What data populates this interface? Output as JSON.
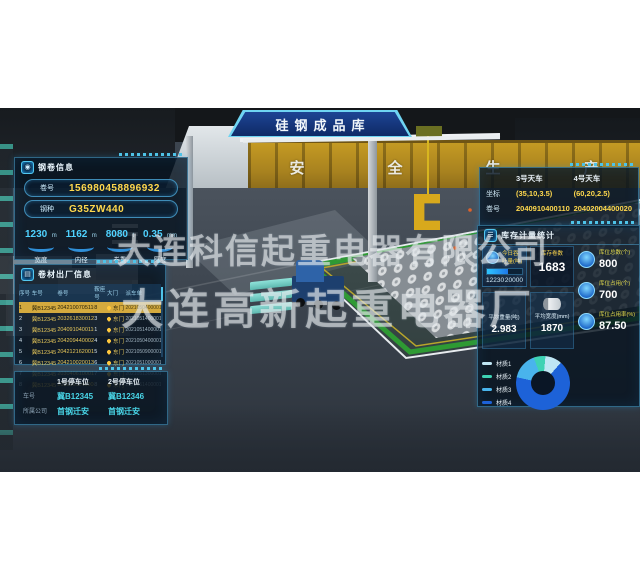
{
  "banner": {
    "title": "硅钢成品库"
  },
  "watermark": {
    "line1": "大连科信起重电器有限公司",
    "line2": "大连高新起重电器厂"
  },
  "scene": {
    "girder_text": [
      "安",
      "全",
      "生",
      "产"
    ]
  },
  "coil_info": {
    "title": "钢卷信息",
    "fields": [
      {
        "label": "卷号",
        "value": "156980458896932"
      },
      {
        "label": "钢种",
        "value": "G35ZW440"
      }
    ],
    "stats": [
      {
        "value": "1230",
        "unit": "m",
        "label": "宽度"
      },
      {
        "value": "1162",
        "unit": "m",
        "label": "内径"
      },
      {
        "value": "8080",
        "unit": "t",
        "label": "卷重"
      },
      {
        "value": "0.35",
        "unit": "mm",
        "label": "厚度"
      }
    ]
  },
  "shipment": {
    "title": "卷材出厂信息",
    "columns": [
      "序号",
      "车号",
      "卷号",
      "鞍座号",
      "大门",
      "派车单"
    ],
    "rows": [
      {
        "no": "1",
        "truck": "冀B12345",
        "coil": "2042100705110",
        "seat": "8",
        "gate": "东门",
        "dispatch": "2021050400001"
      },
      {
        "no": "2",
        "truck": "冀B12345",
        "coil": "2032618300120",
        "seat": "3",
        "gate": "东门",
        "dispatch": "2021051400001"
      },
      {
        "no": "3",
        "truck": "冀B12345",
        "coil": "2040910400110",
        "seat": "1",
        "gate": "东门",
        "dispatch": "2021051400001"
      },
      {
        "no": "4",
        "truck": "冀B12345",
        "coil": "2042094400020",
        "seat": "4",
        "gate": "东门",
        "dispatch": "2021050400001"
      },
      {
        "no": "5",
        "truck": "冀B12345",
        "coil": "2042121620010",
        "seat": "5",
        "gate": "东门",
        "dispatch": "2021050900001"
      },
      {
        "no": "6",
        "truck": "冀B12345",
        "coil": "2042100200130",
        "seat": "6",
        "gate": "东门",
        "dispatch": "2021051000001"
      },
      {
        "no": "7",
        "truck": "冀B12345",
        "coil": "2030406100010",
        "seat": "7",
        "gate": "东门",
        "dispatch": "2021051300001"
      },
      {
        "no": "8",
        "truck": "冀B12345",
        "coil": "2030261140000",
        "seat": "8",
        "gate": "东门",
        "dispatch": "2021051400001"
      }
    ]
  },
  "parking": {
    "labels": {
      "plate": "车号",
      "company": "所属公司"
    },
    "spots": [
      {
        "title": "1号停车位",
        "plate": "冀B12345",
        "company": "首钢迁安"
      },
      {
        "title": "2号停车位",
        "plate": "冀B12346",
        "company": "首钢迁安"
      }
    ]
  },
  "cranes": {
    "row_labels": {
      "coord": "坐标",
      "coil": "卷号"
    },
    "items": [
      {
        "name": "3号天车",
        "coord": "(35,10,3.5)",
        "coil": "2040910400110"
      },
      {
        "name": "4号天车",
        "coord": "(60,20,2.5)",
        "coil": "20402004400020"
      }
    ]
  },
  "inventory": {
    "title": "库存计量统计",
    "throughput": {
      "label": "今日吞吐量(吨)",
      "current": "12230",
      "max": "20000",
      "percent": 61
    },
    "coil_count": {
      "label": "库存卷数",
      "value": "1683"
    },
    "avg_weight": {
      "label": "平均重量(吨)",
      "value": "2.983"
    },
    "avg_width": {
      "label": "平均宽度(mm)",
      "value": "1870"
    },
    "right_stats": [
      {
        "label": "库位总数(个)",
        "value": "800"
      },
      {
        "label": "库位占用(个)",
        "value": "700"
      },
      {
        "label": "库位占用率(%)",
        "value": "87.50"
      }
    ]
  },
  "chart_data": {
    "type": "pie",
    "title": "材质占比",
    "labels": [
      "材质1",
      "材质2",
      "材质3",
      "材质4"
    ],
    "values": [
      10,
      7,
      16,
      67
    ],
    "colors": [
      "#bfe6f4",
      "#3ed2b4",
      "#49b4ec",
      "#1d62d8"
    ],
    "legend_position": "left"
  }
}
